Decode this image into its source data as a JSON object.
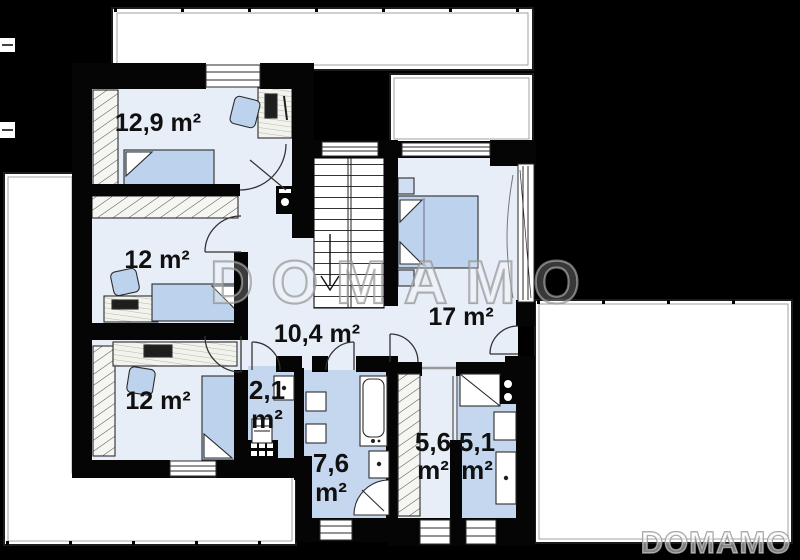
{
  "floor_plan": {
    "watermarks": {
      "center_text": "DOMAMO",
      "corner_text": "DOMAMO"
    },
    "colors": {
      "background": "#000000",
      "wall": "#050505",
      "floor": "#e8eef8",
      "wet_floor": "#c4d7ef",
      "terrace": "#ffffff",
      "furniture": "#bdd3ed",
      "label_text": "#101010",
      "watermark": "#8f8f8f"
    },
    "rooms": [
      {
        "id": "bedroom-1",
        "label": "12,9 m²"
      },
      {
        "id": "bedroom-2",
        "label": "12 m²"
      },
      {
        "id": "bedroom-3",
        "label": "12 m²"
      },
      {
        "id": "hallway",
        "label": "10,4 m²"
      },
      {
        "id": "bedroom-4",
        "label": "17 m²"
      },
      {
        "id": "wc",
        "label_lines": [
          "2,1",
          "m²"
        ]
      },
      {
        "id": "bathroom",
        "label_lines": [
          "7,6",
          "m²"
        ]
      },
      {
        "id": "wardrobe",
        "label_lines": [
          "5,6",
          "m²"
        ]
      },
      {
        "id": "utility",
        "label_lines": [
          "5,1",
          "m²"
        ]
      }
    ]
  }
}
